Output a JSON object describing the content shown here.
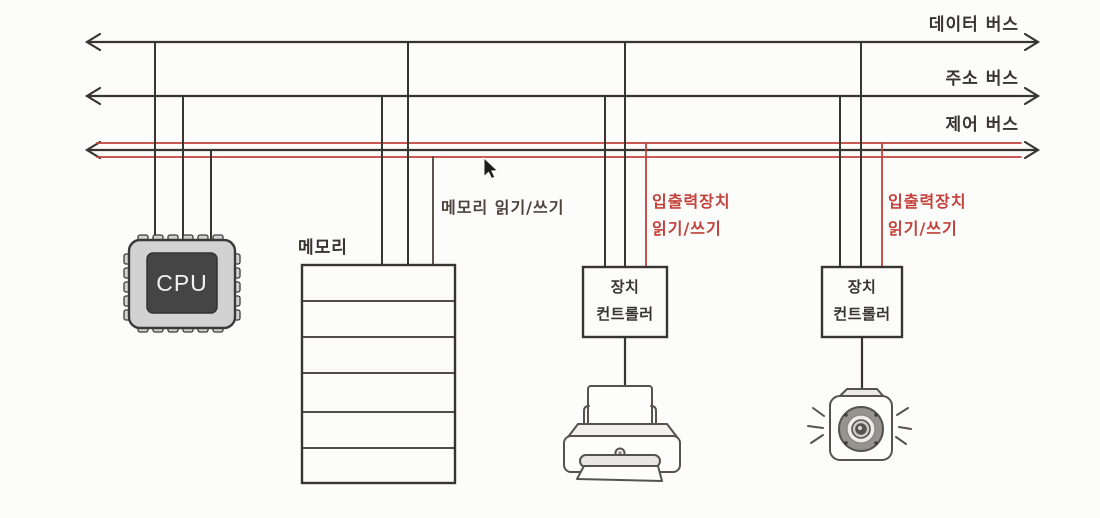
{
  "page": {
    "background": "#fcfcfb"
  },
  "colors": {
    "ink": "#383430",
    "accent_red": "#c2413b",
    "device_outline": "#56524e",
    "cpu_body": "#d2d2d2",
    "cpu_die": "#454545"
  },
  "buses": {
    "data": {
      "label": "데이터 버스"
    },
    "address": {
      "label": "주소 버스"
    },
    "control": {
      "label": "제어 버스"
    }
  },
  "cpu": {
    "label": "CPU"
  },
  "memory": {
    "label": "메모리",
    "row_count": 6,
    "annotation": "메모리 읽기/쓰기"
  },
  "device_controllers": [
    {
      "label_line1": "장치",
      "label_line2": "컨트롤러",
      "annotation_line1": "입출력장치",
      "annotation_line2": "읽기/쓰기",
      "device": "printer"
    },
    {
      "label_line1": "장치",
      "label_line2": "컨트롤러",
      "annotation_line1": "입출력장치",
      "annotation_line2": "읽기/쓰기",
      "device": "camera"
    }
  ]
}
